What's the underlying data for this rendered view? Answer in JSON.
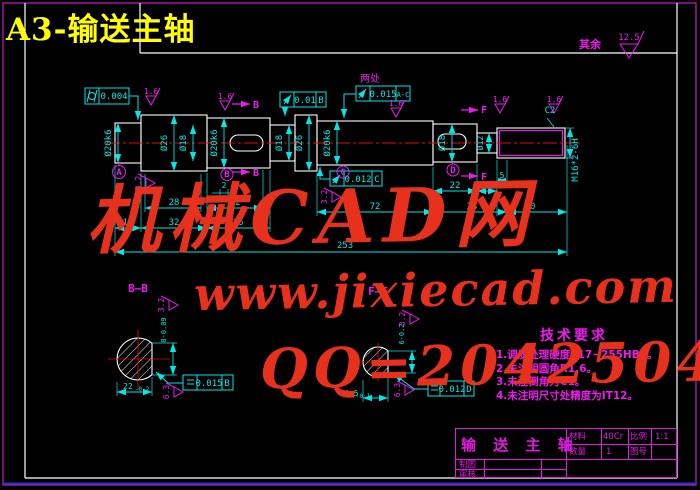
{
  "frame": {
    "doc_title": "A3-输送主轴",
    "surface_note": "其余",
    "surface_default": "12.5"
  },
  "colors": {
    "cyan": "#00e8e8",
    "magenta": "#f018f0",
    "white": "#ffffff",
    "red": "#dd1100",
    "watermark_red": "#e8311c",
    "yellow": "#ffff00",
    "blue": "#2233cc"
  },
  "watermark": {
    "line1": "机械CAD网",
    "line2": "www.jixiecad.com",
    "line3": "QQ=20425042"
  },
  "tech": {
    "title": "技术要求",
    "items": [
      "1.调质处理硬度217~255HBS。",
      "2.未注明圆角R1.6。",
      "3.未注倒角为C1。",
      "4.未注明尺寸处精度为IT12。"
    ]
  },
  "title_block": {
    "part_name": "输 送 主 轴",
    "material_label": "材料",
    "material_value": "40Cr",
    "scale_label": "比例",
    "scale_value": "1:1",
    "qty_label": "数量",
    "qty_value": "1",
    "dwgno_label": "图号",
    "dwgno_value": "",
    "drawn_label": "制图",
    "checked_label": "审核"
  },
  "labels": [
    {
      "n": "dim-28",
      "t": "28",
      "x": 174,
      "y": 205
    },
    {
      "n": "dim-32-top",
      "t": "32",
      "x": 235,
      "y": 205
    },
    {
      "n": "dim-2",
      "t": "2",
      "x": 224,
      "y": 188,
      "s": 8
    },
    {
      "n": "dim-11",
      "t": "11",
      "x": 128,
      "y": 225
    },
    {
      "n": "dim-32-bottom",
      "t": "32",
      "x": 174,
      "y": 225
    },
    {
      "n": "dim-36",
      "t": "36",
      "x": 238,
      "y": 225
    },
    {
      "n": "dim-22",
      "t": "22",
      "x": 455,
      "y": 188
    },
    {
      "n": "dim-6",
      "t": "6",
      "x": 487,
      "y": 188
    },
    {
      "n": "dim-5",
      "t": "5",
      "x": 502,
      "y": 178,
      "s": 8
    },
    {
      "n": "dim-72",
      "t": "72",
      "x": 375,
      "y": 209
    },
    {
      "n": "dim-34",
      "t": "34",
      "x": 472,
      "y": 209
    },
    {
      "n": "dim-30",
      "t": "30",
      "x": 530,
      "y": 209
    },
    {
      "n": "dim-253",
      "t": "253",
      "x": 345,
      "y": 248
    },
    {
      "n": "dia-label-1",
      "t": "Ø20k6",
      "x": 111,
      "y": 143,
      "r": -90
    },
    {
      "n": "dia-label-2",
      "t": "Ø26",
      "x": 167,
      "y": 143,
      "r": -90
    },
    {
      "n": "dia-label-3",
      "t": "Ø18",
      "x": 186,
      "y": 143,
      "r": -90
    },
    {
      "n": "dia-label-4",
      "t": "Ø20k6",
      "x": 217,
      "y": 143,
      "r": -90
    },
    {
      "n": "dia-label-5",
      "t": "Ø18",
      "x": 282,
      "y": 143,
      "r": -90
    },
    {
      "n": "dia-label-6",
      "t": "Ø26",
      "x": 302,
      "y": 143,
      "r": -90
    },
    {
      "n": "dia-label-7",
      "t": "Ø20k6",
      "x": 330,
      "y": 143,
      "r": -90
    },
    {
      "n": "dia-label-8",
      "t": "Ø18",
      "x": 445,
      "y": 143,
      "r": -90
    },
    {
      "n": "dia-label-9",
      "t": "Ø12",
      "x": 483,
      "y": 143,
      "r": -90,
      "s": 8
    },
    {
      "n": "thread-callout",
      "t": "M16*2-6H",
      "x": 578,
      "y": 160,
      "r": -90
    },
    {
      "n": "gdt-cylindricity-value",
      "t": "0.004",
      "x": 114,
      "y": 99
    },
    {
      "n": "gdt-runout1-value",
      "t": "0.01",
      "x": 305,
      "y": 103
    },
    {
      "n": "gdt-runout1-datum",
      "t": "B",
      "x": 321,
      "y": 103
    },
    {
      "n": "gdt-note-two-places",
      "t": "两处",
      "x": 370,
      "y": 82,
      "c": "magenta",
      "s": 10
    },
    {
      "n": "gdt-runout2-value",
      "t": "0.015",
      "x": 383,
      "y": 97
    },
    {
      "n": "gdt-runout2-datum",
      "t": "A-C",
      "x": 403,
      "y": 97,
      "s": 7
    },
    {
      "n": "gdt-runout3-value",
      "t": "0.012",
      "x": 358,
      "y": 182
    },
    {
      "n": "gdt-runout3-datum",
      "t": "C",
      "x": 377,
      "y": 182
    },
    {
      "n": "gdt-symmetry1-value",
      "t": "0.015",
      "x": 209,
      "y": 386
    },
    {
      "n": "gdt-symmetry1-datum",
      "t": "B",
      "x": 227,
      "y": 386
    },
    {
      "n": "gdt-symmetry2-value",
      "t": "0.012",
      "x": 452,
      "y": 392
    },
    {
      "n": "gdt-symmetry2-datum",
      "t": "D",
      "x": 469,
      "y": 392
    },
    {
      "n": "sf-1",
      "t": "1.6",
      "x": 151,
      "y": 94,
      "c": "magenta",
      "s": 8
    },
    {
      "n": "sf-2",
      "t": "1.6",
      "x": 225,
      "y": 99,
      "c": "magenta",
      "s": 8
    },
    {
      "n": "sf-3",
      "t": "1.6",
      "x": 396,
      "y": 106,
      "c": "magenta",
      "s": 8
    },
    {
      "n": "sf-4",
      "t": "1.6",
      "x": 500,
      "y": 102,
      "c": "magenta",
      "s": 8
    },
    {
      "n": "sf-5",
      "t": "1.6",
      "x": 554,
      "y": 102,
      "c": "magenta",
      "s": 8
    },
    {
      "n": "sf-default-value",
      "t": "12.5",
      "x": 629,
      "y": 40,
      "c": "magenta",
      "s": 9
    },
    {
      "n": "sf-6",
      "t": "3.2",
      "x": 141,
      "y": 183,
      "r": -90,
      "c": "magenta",
      "s": 8
    },
    {
      "n": "sf-7",
      "t": "3.2",
      "x": 327,
      "y": 197,
      "r": -90,
      "c": "magenta",
      "s": 8
    },
    {
      "n": "sf-8",
      "t": "3.2",
      "x": 164,
      "y": 305,
      "r": -90,
      "c": "magenta",
      "s": 8
    },
    {
      "n": "sf-9",
      "t": "6.3",
      "x": 169,
      "y": 392,
      "r": -90,
      "c": "magenta",
      "s": 8
    },
    {
      "n": "sf-10",
      "t": "3.2",
      "x": 405,
      "y": 319,
      "r": -90,
      "c": "magenta",
      "s": 8
    },
    {
      "n": "sf-11",
      "t": "6.3",
      "x": 400,
      "y": 390,
      "r": -90,
      "c": "magenta",
      "s": 8
    },
    {
      "n": "datum-a-letter",
      "t": "A",
      "x": 119,
      "y": 175,
      "c": "magenta",
      "b": 1
    },
    {
      "n": "datum-b-letter",
      "t": "B",
      "x": 227,
      "y": 177,
      "c": "magenta",
      "b": 1
    },
    {
      "n": "datum-c-letter",
      "t": "C",
      "x": 343,
      "y": 175,
      "c": "magenta",
      "b": 1
    },
    {
      "n": "datum-d-letter",
      "t": "D",
      "x": 453,
      "y": 173,
      "c": "magenta",
      "b": 1
    },
    {
      "n": "section-b-arrow-top-label",
      "t": "B",
      "x": 256,
      "y": 108,
      "c": "magenta",
      "s": 10,
      "b": 1
    },
    {
      "n": "section-b-arrow-bottom-label",
      "t": "B",
      "x": 256,
      "y": 176,
      "c": "magenta",
      "s": 10,
      "b": 1
    },
    {
      "n": "section-f-arrow-top-label",
      "t": "F",
      "x": 484,
      "y": 113,
      "c": "magenta",
      "s": 10,
      "b": 1
    },
    {
      "n": "section-f-arrow-bottom-label",
      "t": "F",
      "x": 484,
      "y": 180,
      "c": "magenta",
      "s": 10,
      "b": 1
    },
    {
      "n": "section-b-title",
      "t": "B—B",
      "x": 138,
      "y": 292,
      "c": "magenta",
      "s": 11,
      "b": 1
    },
    {
      "n": "section-f-title",
      "t": "F—F",
      "x": 378,
      "y": 295,
      "c": "magenta",
      "s": 11,
      "b": 1
    },
    {
      "n": "secb-dim-22",
      "t": "22",
      "x": 128,
      "y": 389,
      "s": 8
    },
    {
      "n": "secb-dim-22-tol",
      "t": "-0.2",
      "x": 142,
      "y": 391,
      "s": 6
    },
    {
      "n": "secb-dim-8",
      "t": "8-0.09",
      "x": 166,
      "y": 330,
      "r": -90,
      "s": 7
    },
    {
      "n": "secf-dim-14-5",
      "t": "14.5",
      "x": 349,
      "y": 396,
      "s": 8
    },
    {
      "n": "secf-dim-14-5-tol",
      "t": "-0.1",
      "x": 363,
      "y": 398,
      "s": 6
    },
    {
      "n": "secf-dim-6",
      "t": "6-0.2",
      "x": 404,
      "y": 334,
      "r": -90,
      "s": 7
    },
    {
      "n": "chamfer-c2",
      "t": "C2",
      "x": 550,
      "y": 113
    },
    {
      "n": "surface-note-text",
      "t": "其余",
      "x": 590,
      "y": 48,
      "c": "magenta",
      "s": 11,
      "b": 1
    }
  ]
}
